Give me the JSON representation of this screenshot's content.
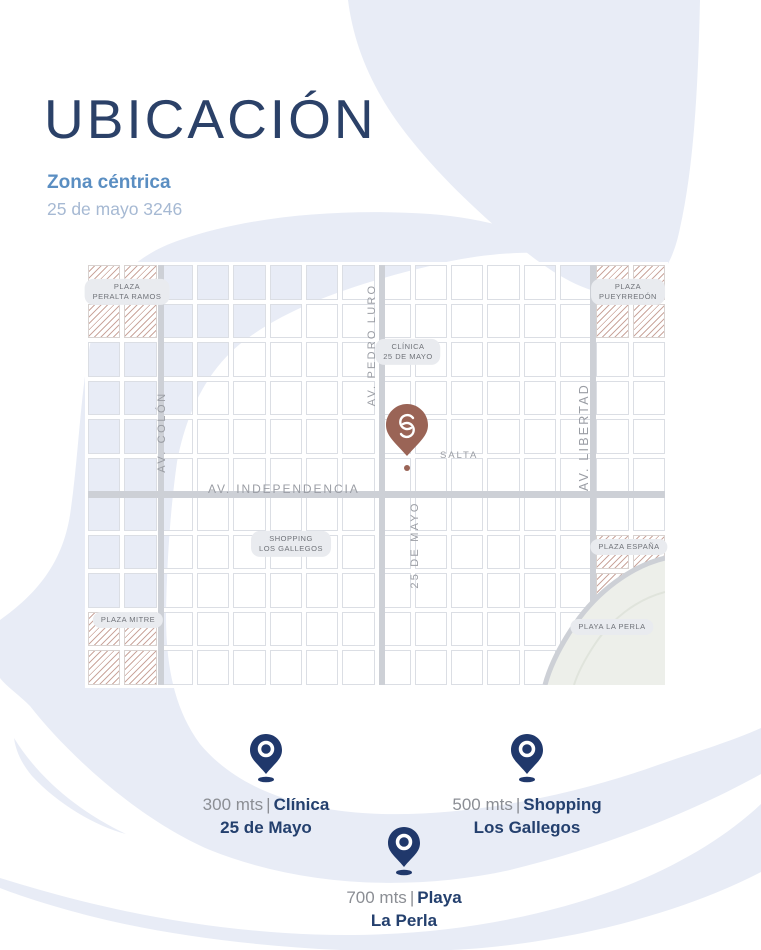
{
  "header": {
    "title": "UBICACIÓN",
    "subtitle": "Zona céntrica",
    "address": "25 de mayo 3246"
  },
  "map": {
    "streets": {
      "colon": "AV. COLÓN",
      "pedro_luro": "AV. PEDRO LURO",
      "libertad": "AV. LIBERTAD",
      "independencia": "AV. INDEPENDENCIA",
      "veinticinco_de_mayo": "25 DE MAYO",
      "salta": "SALTA"
    },
    "places": {
      "peralta_ramos": {
        "line1": "PLAZA",
        "line2": "PERALTA RAMOS"
      },
      "pueyrredon": {
        "line1": "PLAZA",
        "line2": "PUEYRREDÓN"
      },
      "mitre": {
        "line1": "PLAZA MITRE"
      },
      "espana": {
        "line1": "PLAZA ESPAÑA"
      },
      "playa_la_perla": {
        "line1": "PLAYA LA PERLA"
      },
      "clinica": {
        "line1": "CLÍNICA",
        "line2": "25 DE MAYO"
      },
      "shopping": {
        "line1": "SHOPPING",
        "line2": "LOS GALLEGOS"
      }
    },
    "marker": {
      "logo": "S"
    }
  },
  "pois": {
    "separator": "|",
    "items": [
      {
        "distance": "300 mts",
        "name_line1": "Clínica",
        "name_line2": "25 de Mayo"
      },
      {
        "distance": "500 mts",
        "name_line1": "Shopping",
        "name_line2": "Los Gallegos"
      },
      {
        "distance": "700 mts",
        "name_line1": "Playa",
        "name_line2": "La Perla"
      }
    ]
  },
  "colors": {
    "navy_title": "#2B4168",
    "subtitle_blue": "#5A8EC2",
    "address_blue": "#A6B9D3",
    "accent_wave": "#E8ECF6",
    "road_gray": "#CDD0D6",
    "street_text": "#9A9DA4",
    "pill_bg": "#E9EBEF",
    "pill_text": "#6F7278",
    "hatch_stripe": "#CBA79E",
    "marker_terracotta": "#9A6456",
    "poi_navy": "#24406E",
    "poi_gray": "#8B8E94",
    "sand": "#EDEFEA",
    "sand_line": "#E0E4DC",
    "cell_border": "#DBDEE4"
  }
}
